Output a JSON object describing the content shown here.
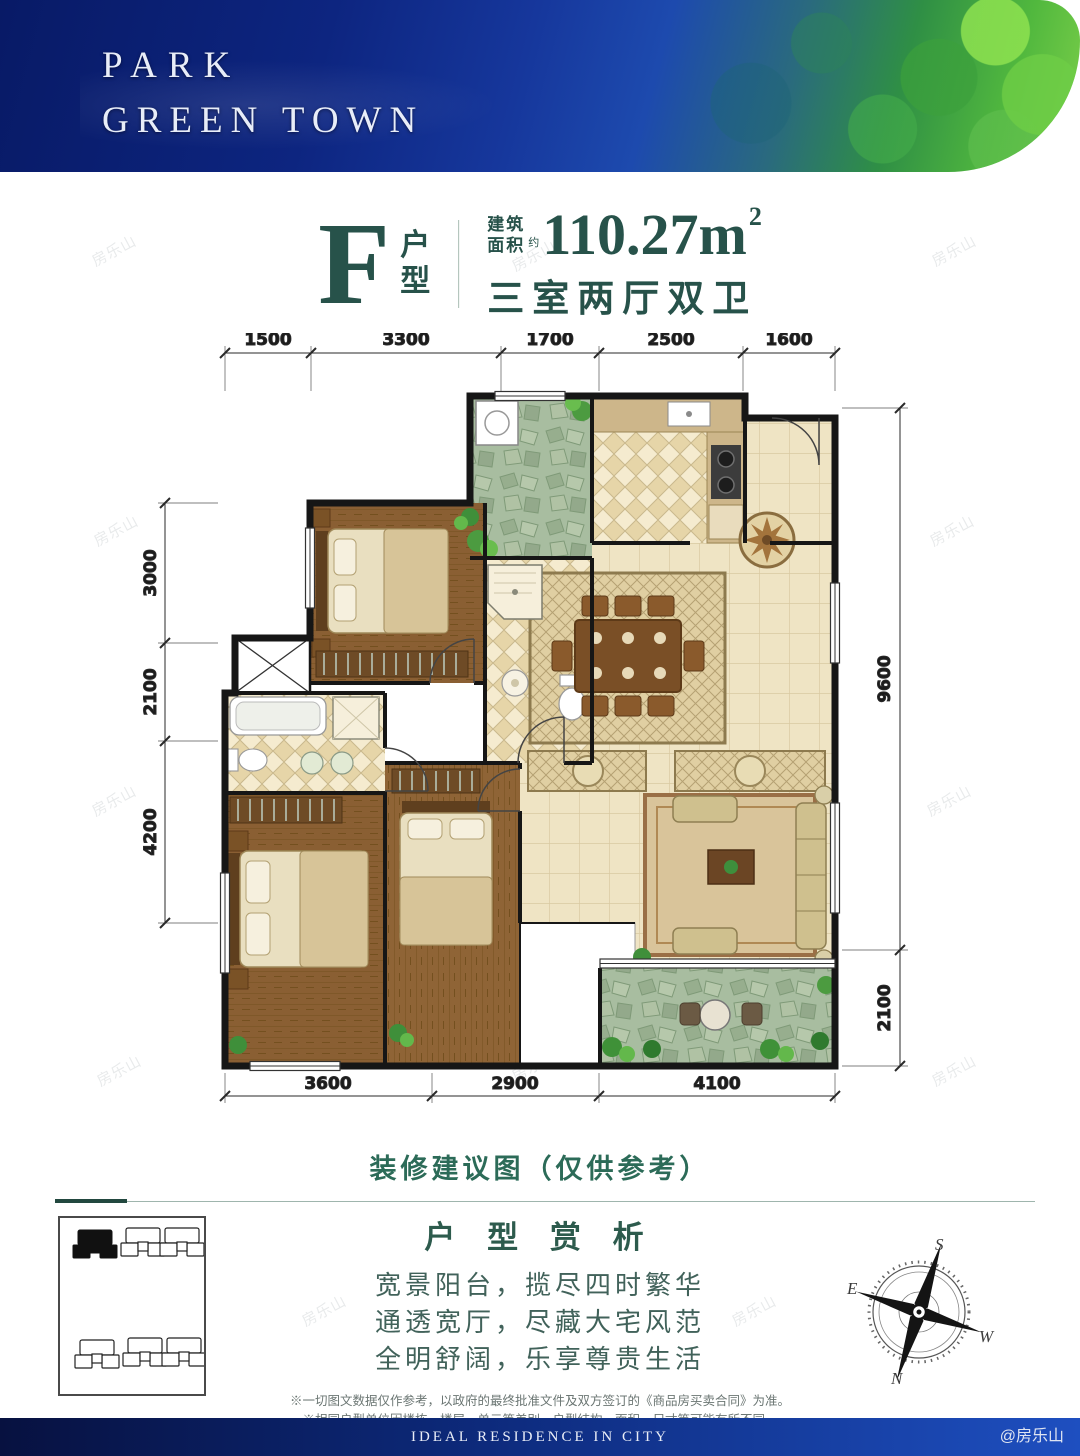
{
  "header": {
    "brand_line1": "PARK",
    "brand_line2": "GREEN TOWN"
  },
  "title": {
    "unit_letter": "F",
    "unit_cjk_top": "户",
    "unit_cjk_bottom": "型",
    "area_prefix_line1": "建筑",
    "area_prefix_line2": "面积",
    "area_approx": "约",
    "area_value": "110.27m",
    "area_superscript": "2",
    "layout_desc": "三室两厅双卫"
  },
  "floorplan": {
    "dims_top": [
      "1500",
      "3300",
      "1700",
      "2500",
      "1600"
    ],
    "dims_left": [
      "3000",
      "2100",
      "4200"
    ],
    "dims_right": [
      "9600",
      "2100"
    ],
    "dims_bottom": [
      "3600",
      "2900",
      "4100"
    ],
    "caption": "装修建议图（仅供参考）"
  },
  "analysis": {
    "title": "户 型 赏 析",
    "lines": [
      "宽景阳台，揽尽四时繁华",
      "通透宽厅，尽藏大宅风范",
      "全明舒阔，乐享尊贵生活"
    ],
    "disclaimers": [
      "※一切图文数据仅作参考，以政府的最终批准文件及双方签订的《商品房买卖合同》为准。",
      "※相同户型单位因楼栋、楼层、单元等差别，户型结构、面积、尺寸等可能有所不同。"
    ]
  },
  "compass": {
    "n": "N",
    "s": "S",
    "e": "E",
    "w": "W"
  },
  "footer": {
    "slogan": "IDEAL RESIDENCE IN CITY",
    "handle": "@房乐山"
  },
  "watermark_text": "房乐山",
  "colors": {
    "accent_teal": "#27524a",
    "header_blue": "#0d2580",
    "wood": "#8a5f33",
    "tile": "#efe4c4",
    "stone_green": "#a8bda0"
  }
}
